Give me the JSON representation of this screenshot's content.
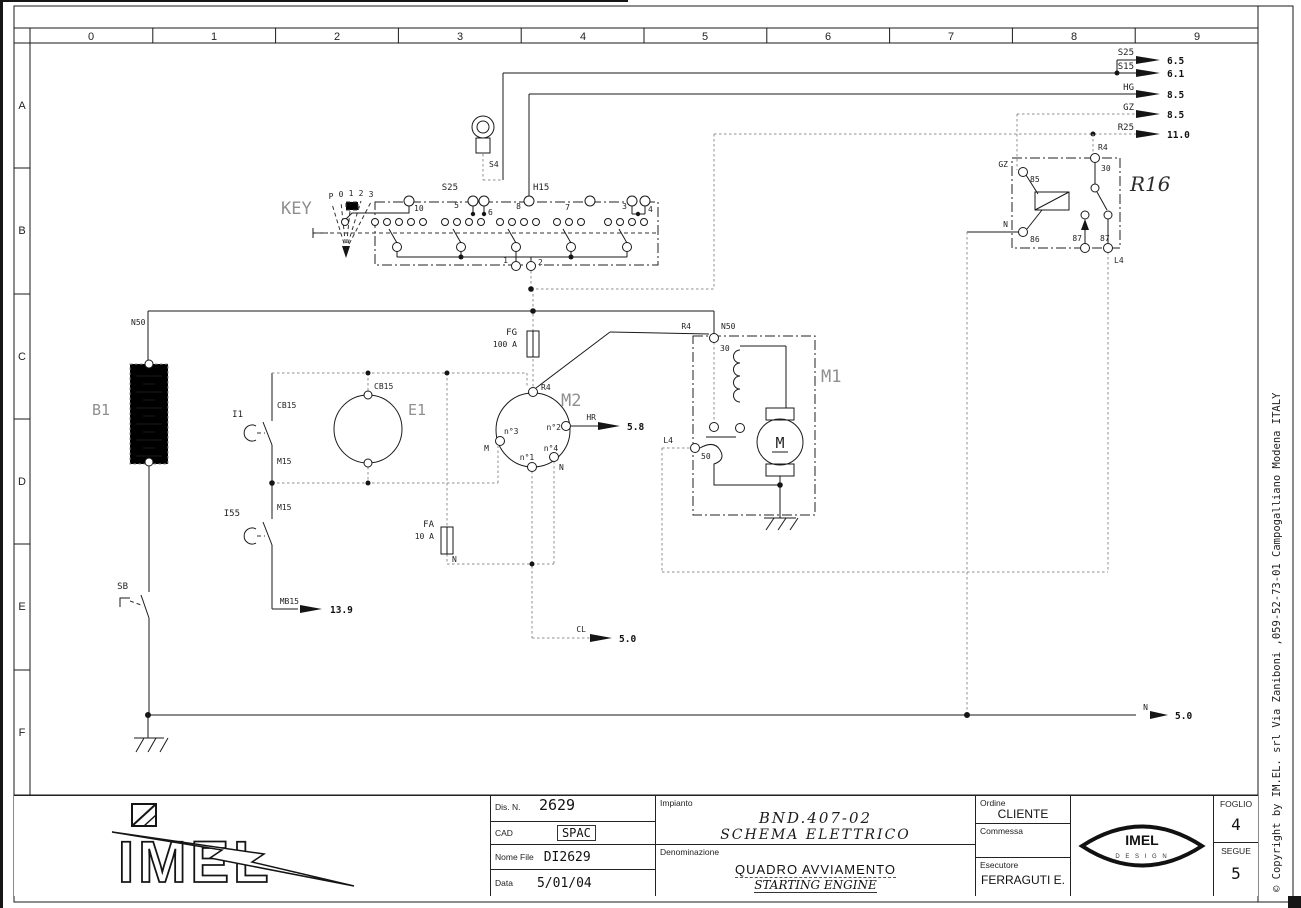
{
  "rulers": {
    "columns": [
      "0",
      "1",
      "2",
      "3",
      "4",
      "5",
      "6",
      "7",
      "8",
      "9"
    ],
    "rows": [
      "A",
      "B",
      "C",
      "D",
      "E",
      "F"
    ]
  },
  "labels": {
    "s25": "S25",
    "s25_dest": "6.5",
    "s15": "S15",
    "s15_dest": "6.1",
    "hg": "HG",
    "hg_dest": "8.5",
    "gz": "GZ",
    "gz_dest": "8.5",
    "r25": "R25",
    "r25_dest": "11.0",
    "r16": "R16",
    "r16_r4": "R4",
    "r16_t30": "30",
    "r16_t85": "85",
    "r16_t86": "86",
    "r16_t87a": "87",
    "r16_t87b": "87",
    "r16_gz": "GZ",
    "r16_n": "N",
    "r16_l4": "L4",
    "key": "KEY",
    "key_s4": "S4",
    "key_s25": "S25",
    "key_h15": "H15",
    "key_pos_p": "P",
    "key_pos_0": "0",
    "key_pos_1": "1",
    "key_pos_2": "2",
    "key_pos_3": "3",
    "key_t10": "10",
    "key_t5": "5",
    "key_t6": "6",
    "key_t8": "8",
    "key_t7": "7",
    "key_t3": "3",
    "key_t4": "4",
    "key_b1": "1",
    "key_b2": "2",
    "n50": "N50",
    "b1": "B1",
    "sb": "SB",
    "i1": "I1",
    "i1_cb15": "CB15",
    "i1_m15": "M15",
    "i55": "I55",
    "i55_m15": "M15",
    "mb15": "MB15",
    "mb15_dest": "13.9",
    "e1": "E1",
    "e1_cb15": "CB15",
    "fg": "FG",
    "fg_rating": "100 A",
    "fa": "FA",
    "fa_rating": "10 A",
    "fa_n": "N",
    "m2": "M2",
    "m2_r4": "R4",
    "m2_n1": "n°1",
    "m2_n2": "n°2",
    "m2_n3": "n°3",
    "m2_n4": "n°4",
    "m2_m": "M",
    "m2_n": "N",
    "hr": "HR",
    "hr_dest": "5.8",
    "cl": "CL",
    "cl_dest": "5.0",
    "m1": "M1",
    "m1_r4": "R4",
    "m1_n50": "N50",
    "m1_t30": "30",
    "m1_t50": "50",
    "m1_l4": "L4",
    "m1_motor": "M",
    "n_bottom": "N",
    "n_bottom_dest": "5.0"
  },
  "title_block": {
    "dis_n_label": "Dis. N.",
    "dis_n": "2629",
    "cad_label": "CAD",
    "cad": "SPAC",
    "nome_file_label": "Nome File",
    "nome_file": "DI2629",
    "data_label": "Data",
    "data": "5/01/04",
    "impianto_label": "Impianto",
    "impianto_line1": "BND.407-02",
    "impianto_line2": "SCHEMA ELETTRICO",
    "denominazione_label": "Denominazione",
    "denominazione_line1": "QUADRO AVVIAMENTO",
    "denominazione_line2": "STARTING ENGINE",
    "ordine_label": "Ordine",
    "ordine": "CLIENTE",
    "commessa_label": "Commessa",
    "commessa": "",
    "esecutore_label": "Esecutore",
    "esecutore": "FERRAGUTI E.",
    "foglio_label": "FOGLIO",
    "foglio": "4",
    "segue_label": "SEGUE",
    "segue": "5",
    "logo_text": "IMEL",
    "eye_line1": "IMEL",
    "eye_line2": "D E S I G N"
  },
  "margin": {
    "copyright": "© Copyright by IM.EL.  srl Via Zaniboni ,059-52-73-01 Campogalliano Modena ITALY"
  },
  "colors": {
    "line": "#1a1a1a",
    "wire_gray": "#8f8f8f",
    "component_label": "#8f8f8f"
  }
}
